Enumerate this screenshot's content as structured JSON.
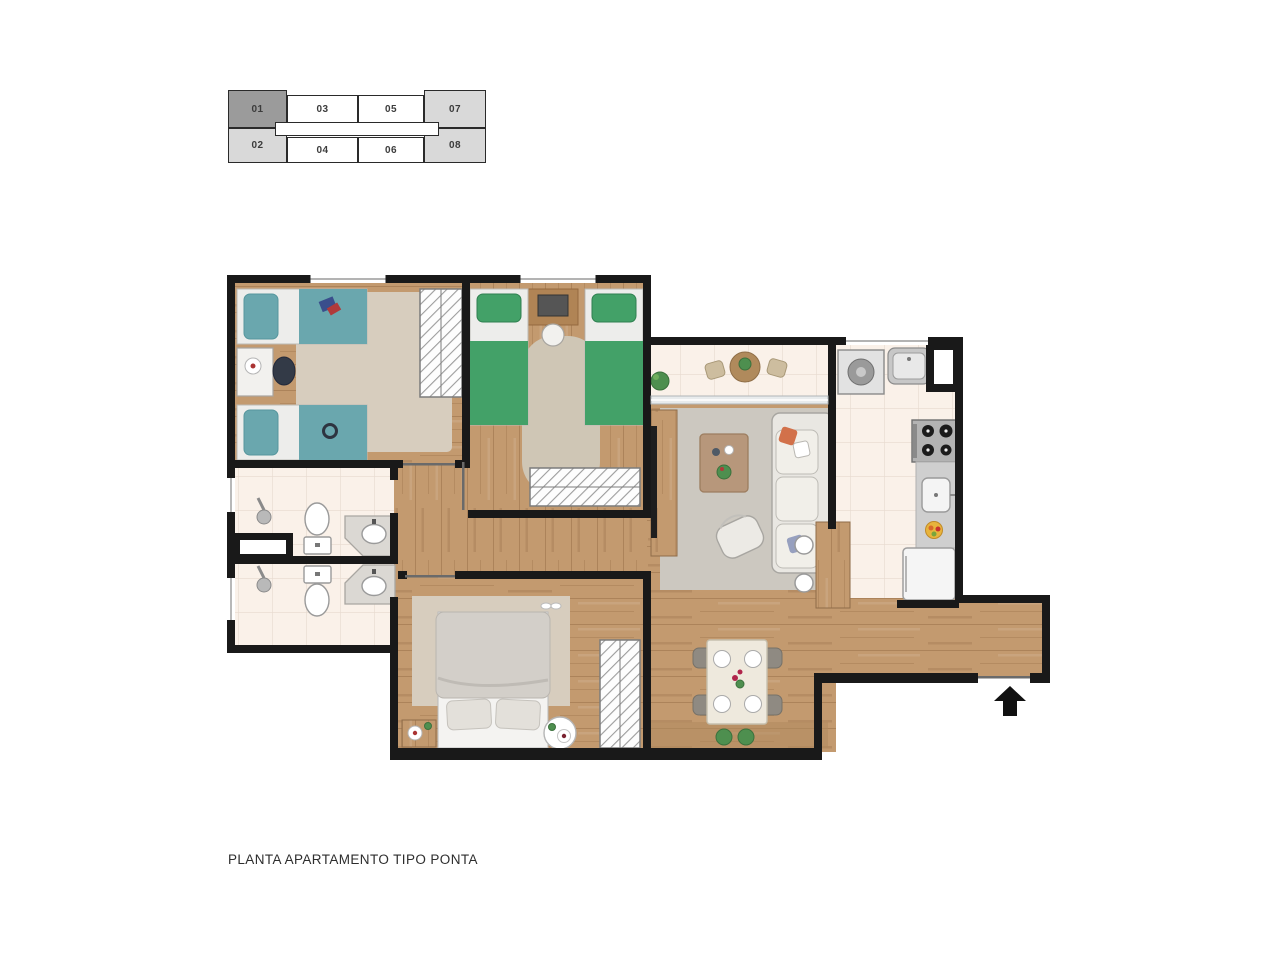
{
  "page": {
    "background": "#ffffff",
    "caption": "PLANTA APARTAMENTO TIPO PONTA"
  },
  "key_plan": {
    "units": [
      {
        "label": "01",
        "highlighted": true
      },
      {
        "label": "02",
        "highlighted": false
      },
      {
        "label": "03",
        "highlighted": false
      },
      {
        "label": "04",
        "highlighted": false
      },
      {
        "label": "05",
        "highlighted": false
      },
      {
        "label": "06",
        "highlighted": false
      },
      {
        "label": "07",
        "highlighted": false
      },
      {
        "label": "08",
        "highlighted": false
      }
    ]
  },
  "floor_plan": {
    "rooms": [
      "bedroom-1",
      "bedroom-2",
      "bathroom-1",
      "bathroom-2",
      "hallway",
      "master-bedroom",
      "living-room",
      "dining-room",
      "kitchen",
      "laundry",
      "balcony",
      "entry-corridor"
    ],
    "entry_marker": "entrance-arrow"
  },
  "colors": {
    "wall": "#191919",
    "outline": "#2a2a2a",
    "unit_highlight": "#9b9b9b",
    "unit_side": "#d9d9d9",
    "wood": "#c39a6f",
    "wood_dark": "#ad8258",
    "tile": "#faf1e9",
    "tile_line": "#e7dacf",
    "rug_beige": "#d7cdbe",
    "rug_gray": "#ccc8c0",
    "bed_teal": "#6aa7ae",
    "bed_green": "#43a168",
    "linen": "#ededeb",
    "duvet_gray": "#d3cfc9",
    "furn_white": "#f2f1ee",
    "furn_stroke": "#a8a5a0",
    "counter": "#cfcfcf",
    "steel": "#c7c7c7",
    "plant": "#4e8f4f",
    "accent_orange": "#d2714a",
    "accent_blue": "#97a0bf"
  }
}
